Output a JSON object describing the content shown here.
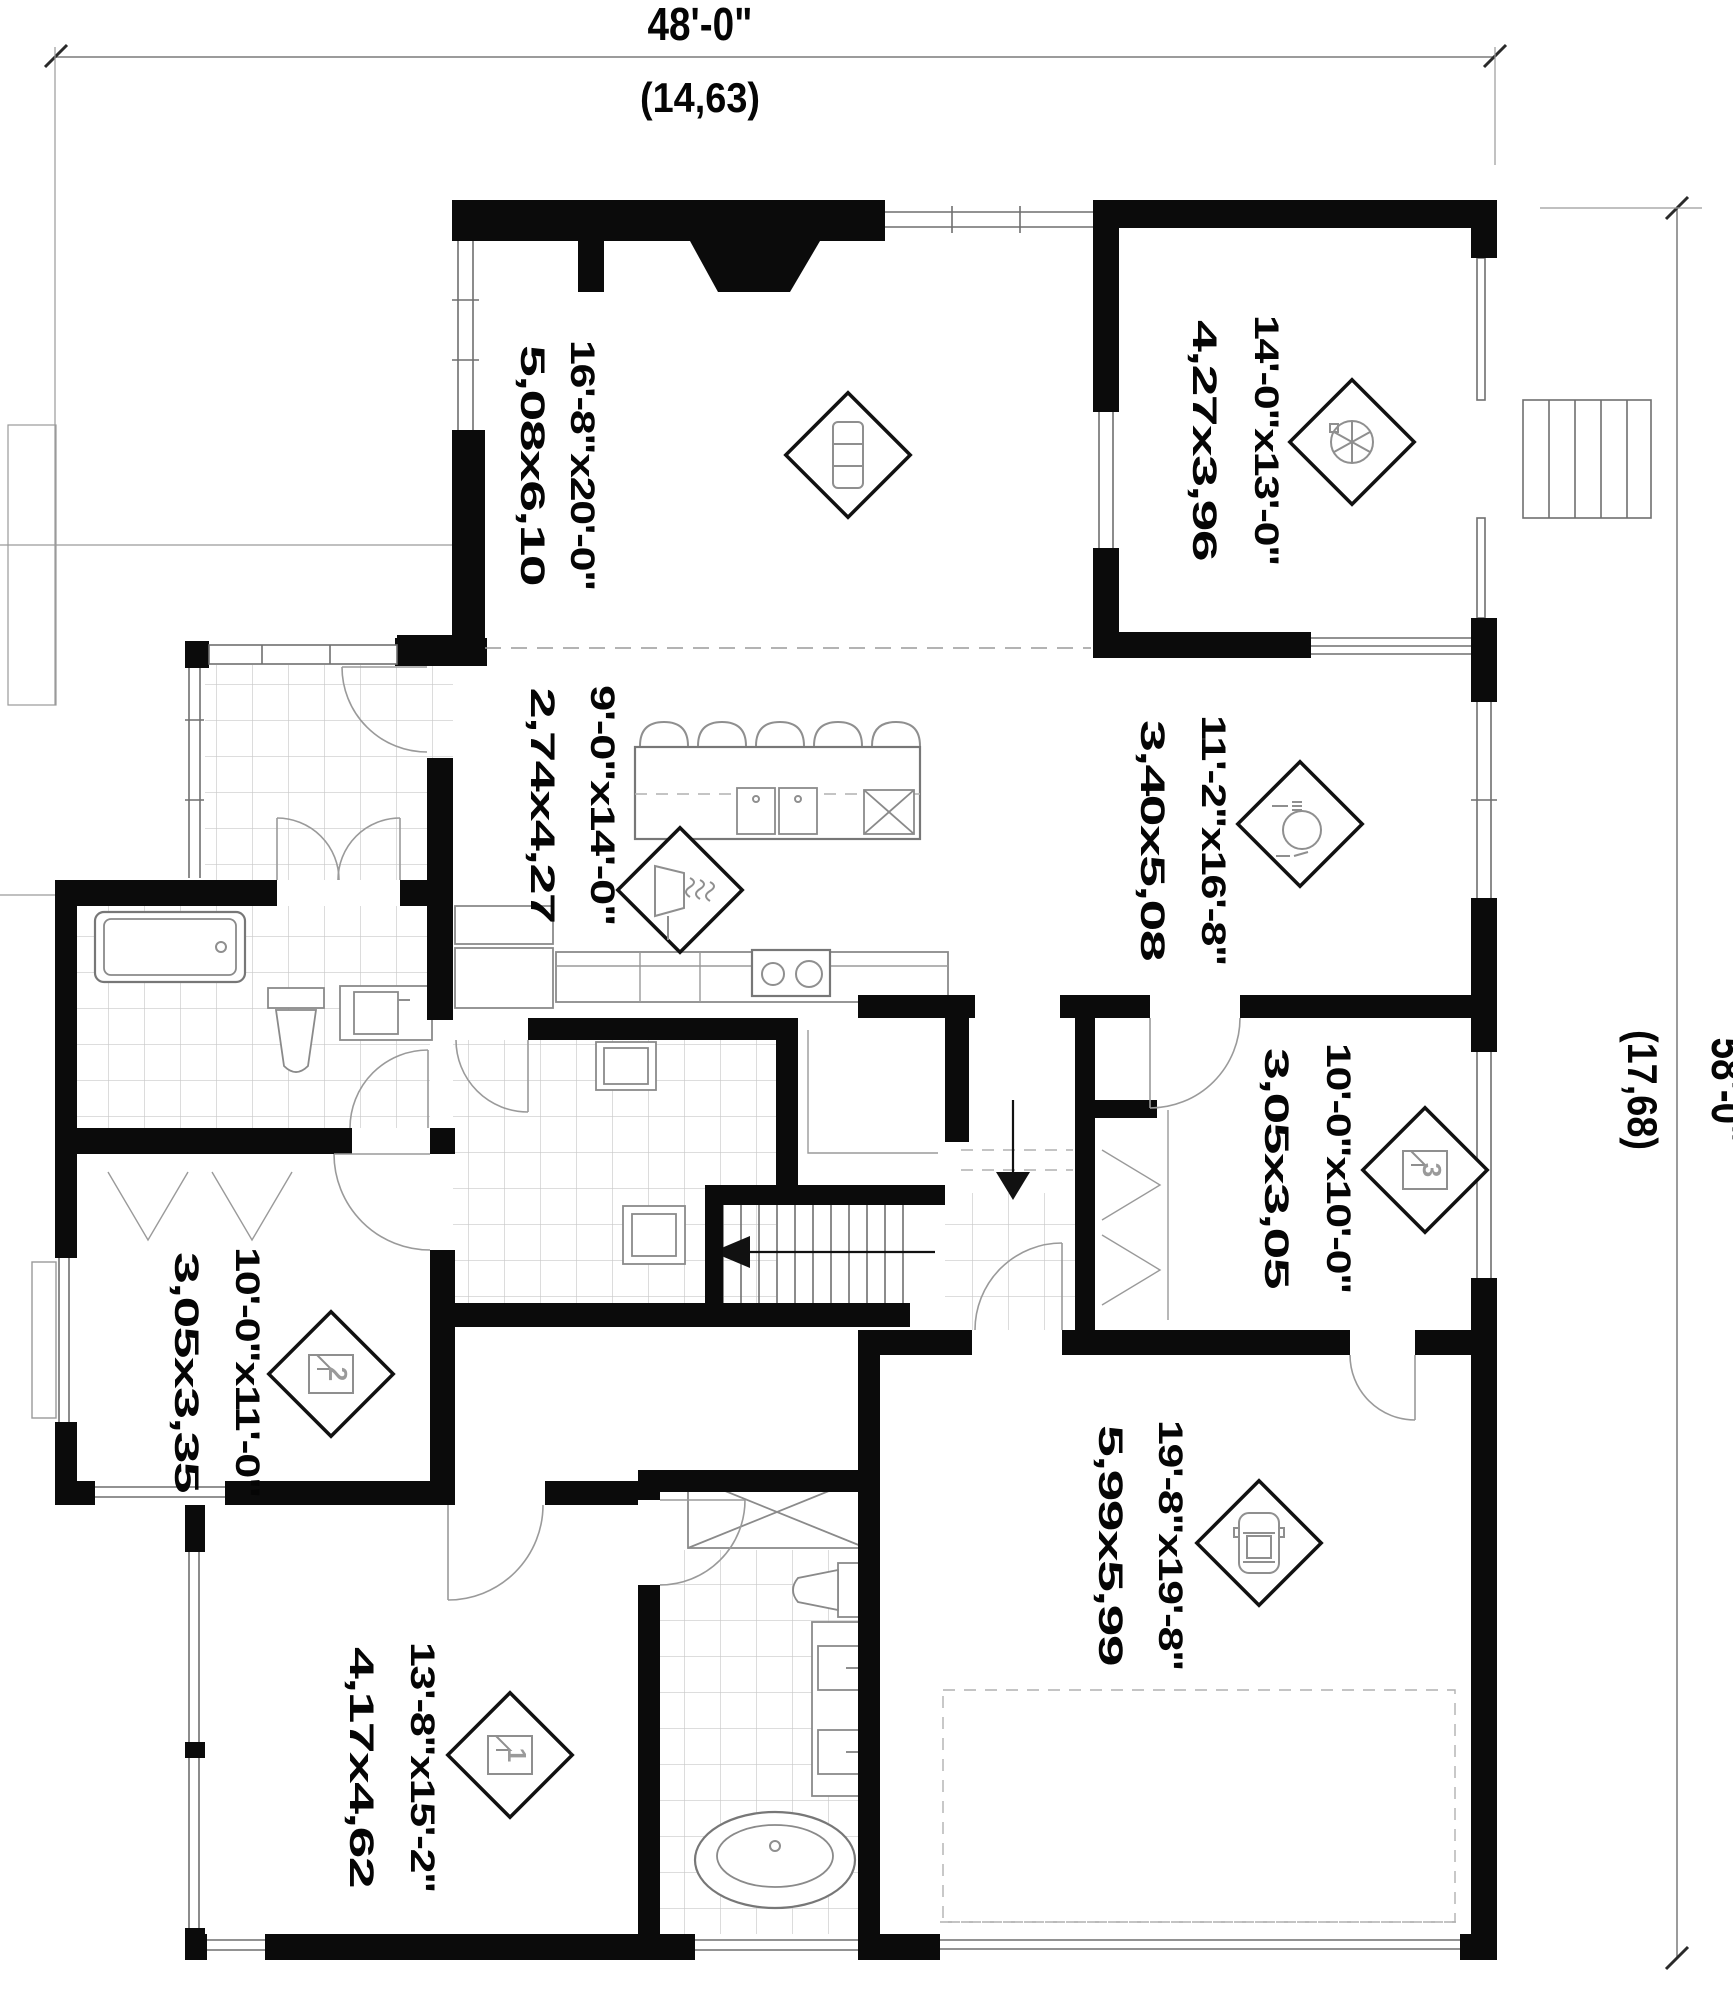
{
  "plan": {
    "overall": {
      "width_label": "48'-0\"",
      "width_metric": "(14,63)",
      "height_label": "58'-0\"",
      "height_metric": "(17,68)"
    },
    "rooms": [
      {
        "id": "living-room",
        "imperial": "16'-8\"x20'-0\"",
        "metric": "5,08x6,10",
        "icon": "sofa"
      },
      {
        "id": "terrace",
        "imperial": "14'-0\"x13'-0\"",
        "metric": "4,27x3,96",
        "icon": "patio-table"
      },
      {
        "id": "kitchen",
        "imperial": "9'-0\"x14'-0\"",
        "metric": "2,74x4,27",
        "icon": "range-hood"
      },
      {
        "id": "dining-room",
        "imperial": "11'-2\"x16'-8\"",
        "metric": "3,40x5,08",
        "icon": "dining-plate"
      },
      {
        "id": "bedroom-3",
        "imperial": "10'-0\"x10'-0\"",
        "metric": "3,05x3,05",
        "icon": "bed",
        "number": "3"
      },
      {
        "id": "bedroom-2",
        "imperial": "10'-0\"x11'-0\"",
        "metric": "3,05x3,35",
        "icon": "bed",
        "number": "2"
      },
      {
        "id": "garage",
        "imperial": "19'-8\"x19'-8\"",
        "metric": "5,99x5,99",
        "icon": "car"
      },
      {
        "id": "bedroom-1",
        "imperial": "13'-8\"x15'-2\"",
        "metric": "4,17x4,62",
        "icon": "bed",
        "number": "1"
      }
    ],
    "colors": {
      "wall": "#0b0b0b",
      "line": "#6f6f6f",
      "tile": "#c9c9c9",
      "icon": "#8f8f8f"
    }
  }
}
